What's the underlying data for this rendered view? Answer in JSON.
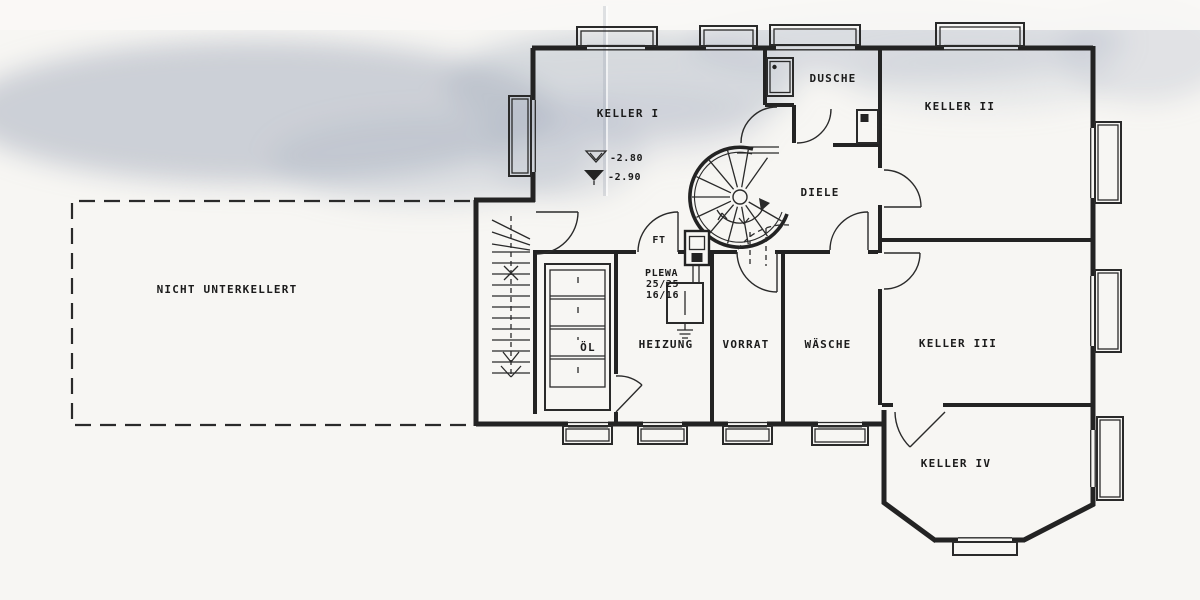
{
  "plan": {
    "rooms": [
      {
        "id": "keller-i",
        "label": "KELLER I"
      },
      {
        "id": "keller-ii",
        "label": "KELLER II"
      },
      {
        "id": "keller-iii",
        "label": "KELLER III"
      },
      {
        "id": "keller-iv",
        "label": "KELLER IV"
      },
      {
        "id": "dusche",
        "label": "DUSCHE"
      },
      {
        "id": "diele",
        "label": "DIELE"
      },
      {
        "id": "waesche",
        "label": "WÄSCHE"
      },
      {
        "id": "vorrat",
        "label": "VORRAT"
      },
      {
        "id": "heizung",
        "label": "HEIZUNG"
      },
      {
        "id": "oel",
        "label": "ÖL"
      }
    ],
    "annotations": {
      "area_note": "NICHT UNTERKELLERT",
      "flue": "FT",
      "chimney": {
        "brand": "PLEWA",
        "size_top": "25/25",
        "size_bottom": "16/16"
      },
      "levels": {
        "floor_upper": "-2.80",
        "floor_lower": "-2.90"
      }
    },
    "icons": {
      "level_upper": "open-triangle-level-mark",
      "level_lower": "filled-triangle-level-mark"
    },
    "colors": {
      "ink": "#232323",
      "paper": "#f7f6f3",
      "scan_shadow": "#aab2c1"
    }
  }
}
